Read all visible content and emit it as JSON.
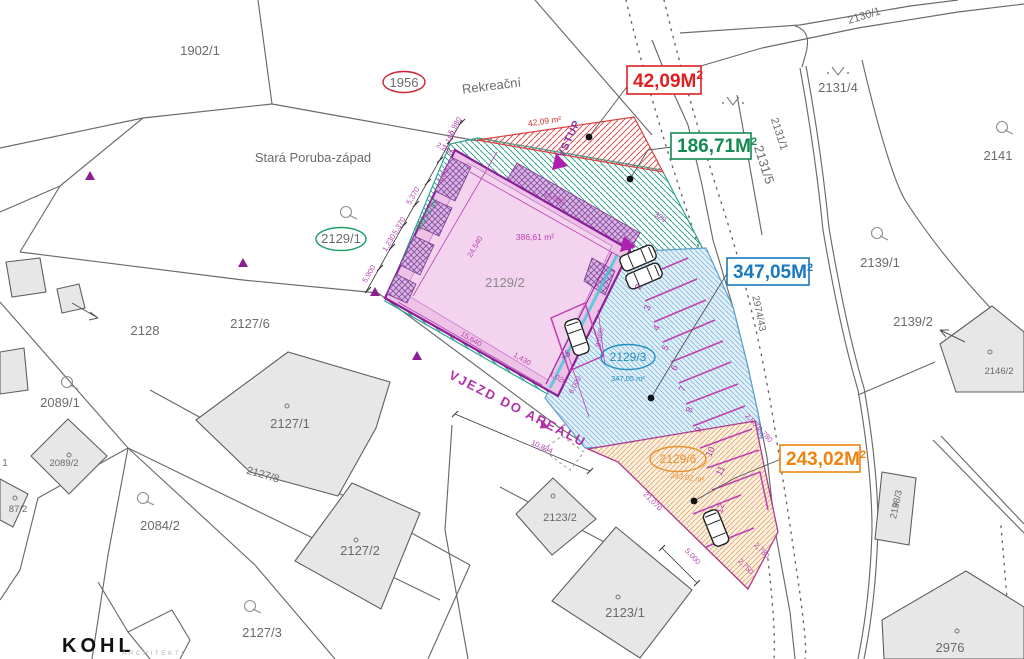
{
  "logo": {
    "name": "KOHL",
    "subtitle": "ARCHITEKTI"
  },
  "labels": {
    "district": "Stará Poruba-západ",
    "street": "Rekreační",
    "entrance_road": "VJEZD DO AREÁLU",
    "entrance_arrow": "▶",
    "entry": "VSTUP"
  },
  "legend": {
    "entrance": {
      "value": "42,09M",
      "sup": "2",
      "color": "#e02020"
    },
    "green_band": {
      "value": "186,71M",
      "sup": "2",
      "color": "#138a52"
    },
    "parking": {
      "value": "347,05M",
      "sup": "2",
      "color": "#1878c0"
    },
    "south": {
      "value": "243,02M",
      "sup": "2",
      "color": "#ef8312"
    }
  },
  "areas": {
    "entrance": "42,09 m²",
    "green_band": "186,71 m²",
    "building": "386,61 m²",
    "parking": "347,05 m²",
    "south": "243,02 m²"
  },
  "parcels": {
    "p1902_1": "1902/1",
    "p1956": "1956",
    "p2129_1": "2129/1",
    "p2129_2": "2129/2",
    "p2129_3": "2129/3",
    "p2129_6": "2129/6",
    "p2128": "2128",
    "p2127_6": "2127/6",
    "p2127_1": "2127/1",
    "p2127_8": "2127/8",
    "p2127_2": "2127/2",
    "p2127_3": "2127/3",
    "p2089_1": "2089/1",
    "p2089_2": "2089/2",
    "p2084_2": "2084/2",
    "p2087_2": "87/2",
    "p_left_1": "1",
    "p2123_2": "2123/2",
    "p2123_1": "2123/1",
    "p2130_1": "2130/1",
    "p2131_4": "2131/4",
    "p2131_1": "2131/1",
    "p2131_5": "2131/5",
    "p2141": "2141",
    "p2139_1": "2139/1",
    "p2139_2": "2139/2",
    "p2146_2": "2146/2",
    "p2138_3": "2138/3",
    "p2976": "2976",
    "p2974_43": "2974/43"
  },
  "dims": {
    "d16980": "16,980",
    "d24540": "24,540",
    "d15640": "15,640",
    "d1430": "1,430",
    "d1020": "1,020",
    "d6000": "6,000",
    "d8000": "8,000",
    "d5900": "5,900",
    "d1230": "1,230",
    "d5370a": "5,370",
    "d5370b": "5,370",
    "d1000": "1,000",
    "d1180": "1,180",
    "d5980": "5,980",
    "d2290": "2,290",
    "d320": "320",
    "d21070": "21,070",
    "d10894": "10,894",
    "d5000": "5,000",
    "d2500": "2,500",
    "d2750": "2,750",
    "d2780a": "2,780",
    "d2780b": "2,780"
  },
  "stalls": {
    "s2": "2",
    "s3": "3",
    "s4": "4",
    "s5": "5",
    "s6": "6",
    "s7": "7",
    "s8": "8",
    "s9": "9",
    "s10": "10",
    "s11": "11",
    "s12": "12",
    "s15": "15"
  }
}
